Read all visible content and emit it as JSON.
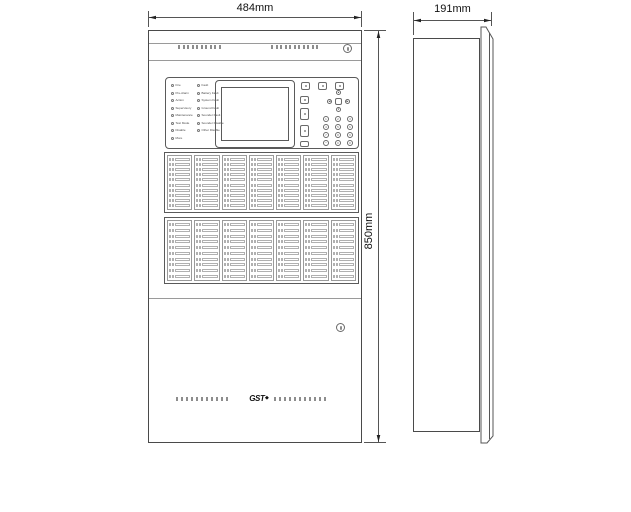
{
  "dimensions": {
    "front_width": "484mm",
    "front_height": "850mm",
    "side_depth": "191mm"
  },
  "logo": {
    "text": "GST",
    "mark": "◆"
  },
  "panel": {
    "led_col_a": [
      "Fire",
      "Pre-Alarm",
      "Action",
      "Supervisory",
      "Maintenance",
      "Test Mode",
      "Disable",
      "More"
    ],
    "led_col_b": [
      "Fault",
      "Battery Fault",
      "System Fault",
      "Ground Fault",
      "Sounder Fault",
      "Sounder Disable",
      "Other Disable"
    ],
    "keypad_digits": [
      "1",
      "2",
      "3",
      "4",
      "5",
      "6",
      "7",
      "8",
      "9",
      "*",
      "0",
      "#"
    ],
    "dpad": {
      "up": "▲",
      "down": "▼",
      "left": "◀",
      "right": "▶"
    }
  },
  "zones": {
    "banks": [
      {
        "cols": 7,
        "rows": 10
      },
      {
        "cols": 7,
        "rows": 10
      }
    ]
  },
  "vents": {
    "top_left": 10,
    "top_right": 11,
    "bottom_left": 11,
    "bottom_right": 11
  }
}
